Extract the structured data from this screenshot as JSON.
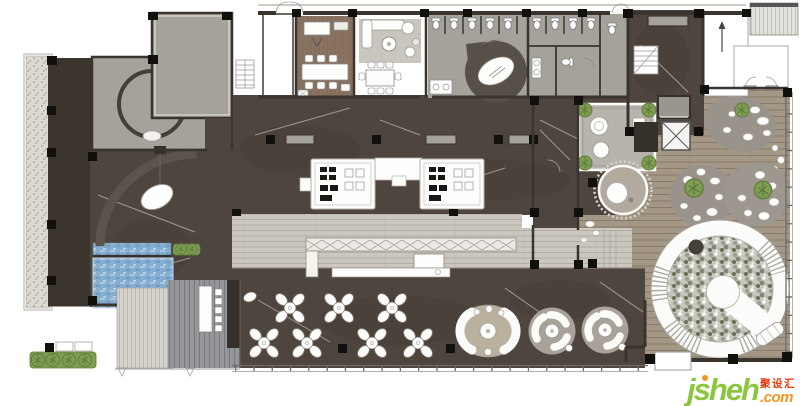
{
  "watermark": {
    "brand": "jsheh",
    "tld": ".com",
    "cn": "聚设汇"
  },
  "palette": {
    "marble": "#4e463e",
    "marble_dark": "#3b352e",
    "wall": "#36302a",
    "gray_room": "#a5a19b",
    "office_wood": "#8a7261",
    "rug": "#c9c5bf",
    "walkway": "#cbc7bf",
    "wood": "#a39786",
    "deck": "#d7d4cd",
    "terrace": "#95959a",
    "water": "#85add0",
    "gravel": "#dcd9d2",
    "green": "#7e9c52",
    "tan": "#b9b09d",
    "lounge": "#a8a299",
    "pebble_bg": "#c9c7be",
    "feature_dark": "#575049",
    "logo_green": "#8cc63e",
    "logo_orange": "#f7941d",
    "logo_red": "#e8380d"
  }
}
